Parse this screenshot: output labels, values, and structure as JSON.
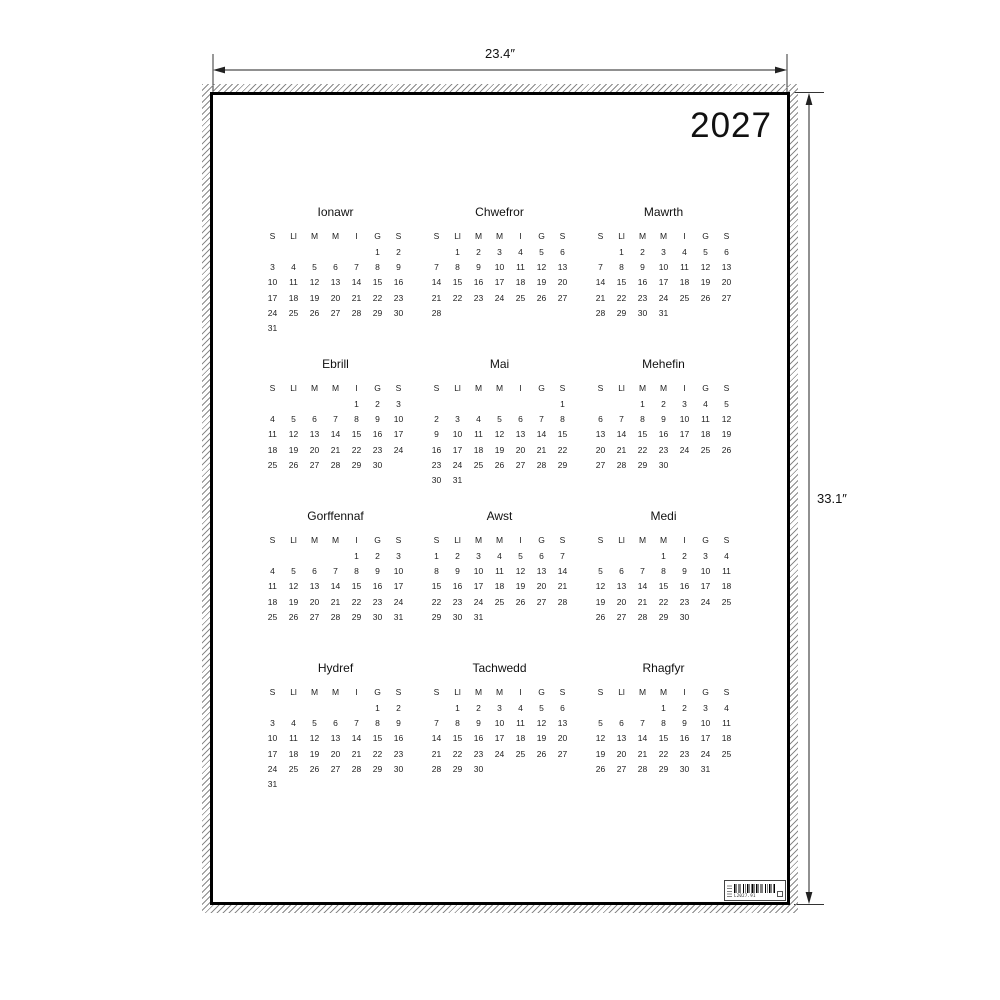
{
  "poster": {
    "year": "2027",
    "width_label": "23.4″",
    "height_label": "33.1″"
  },
  "colors": {
    "ink": "#1a1a1a",
    "poster_border": "#000000",
    "hatch": "#8a8a8a",
    "background": "#ffffff"
  },
  "barcode": {
    "code": "L2027.91"
  },
  "calendar": {
    "day_headers": [
      "S",
      "Ll",
      "M",
      "M",
      "I",
      "G",
      "S"
    ],
    "months": [
      {
        "name": "Ionawr",
        "weeks": [
          [
            "",
            "",
            "",
            "",
            "",
            "1",
            "2"
          ],
          [
            "3",
            "4",
            "5",
            "6",
            "7",
            "8",
            "9"
          ],
          [
            "10",
            "11",
            "12",
            "13",
            "14",
            "15",
            "16"
          ],
          [
            "17",
            "18",
            "19",
            "20",
            "21",
            "22",
            "23"
          ],
          [
            "24",
            "25",
            "26",
            "27",
            "28",
            "29",
            "30"
          ],
          [
            "31",
            "",
            "",
            "",
            "",
            "",
            ""
          ]
        ]
      },
      {
        "name": "Chwefror",
        "weeks": [
          [
            "",
            "1",
            "2",
            "3",
            "4",
            "5",
            "6"
          ],
          [
            "7",
            "8",
            "9",
            "10",
            "11",
            "12",
            "13"
          ],
          [
            "14",
            "15",
            "16",
            "17",
            "18",
            "19",
            "20"
          ],
          [
            "21",
            "22",
            "23",
            "24",
            "25",
            "26",
            "27"
          ],
          [
            "28",
            "",
            "",
            "",
            "",
            "",
            ""
          ],
          [
            "",
            "",
            "",
            "",
            "",
            "",
            ""
          ]
        ]
      },
      {
        "name": "Mawrth",
        "weeks": [
          [
            "",
            "1",
            "2",
            "3",
            "4",
            "5",
            "6"
          ],
          [
            "7",
            "8",
            "9",
            "10",
            "11",
            "12",
            "13"
          ],
          [
            "14",
            "15",
            "16",
            "17",
            "18",
            "19",
            "20"
          ],
          [
            "21",
            "22",
            "23",
            "24",
            "25",
            "26",
            "27"
          ],
          [
            "28",
            "29",
            "30",
            "31",
            "",
            "",
            ""
          ],
          [
            "",
            "",
            "",
            "",
            "",
            "",
            ""
          ]
        ]
      },
      {
        "name": "Ebrill",
        "weeks": [
          [
            "",
            "",
            "",
            "",
            "1",
            "2",
            "3"
          ],
          [
            "4",
            "5",
            "6",
            "7",
            "8",
            "9",
            "10"
          ],
          [
            "11",
            "12",
            "13",
            "14",
            "15",
            "16",
            "17"
          ],
          [
            "18",
            "19",
            "20",
            "21",
            "22",
            "23",
            "24"
          ],
          [
            "25",
            "26",
            "27",
            "28",
            "29",
            "30",
            ""
          ],
          [
            "",
            "",
            "",
            "",
            "",
            "",
            ""
          ]
        ]
      },
      {
        "name": "Mai",
        "weeks": [
          [
            "",
            "",
            "",
            "",
            "",
            "",
            "1"
          ],
          [
            "2",
            "3",
            "4",
            "5",
            "6",
            "7",
            "8"
          ],
          [
            "9",
            "10",
            "11",
            "12",
            "13",
            "14",
            "15"
          ],
          [
            "16",
            "17",
            "18",
            "19",
            "20",
            "21",
            "22"
          ],
          [
            "23",
            "24",
            "25",
            "26",
            "27",
            "28",
            "29"
          ],
          [
            "30",
            "31",
            "",
            "",
            "",
            "",
            ""
          ]
        ]
      },
      {
        "name": "Mehefin",
        "weeks": [
          [
            "",
            "",
            "1",
            "2",
            "3",
            "4",
            "5"
          ],
          [
            "6",
            "7",
            "8",
            "9",
            "10",
            "11",
            "12"
          ],
          [
            "13",
            "14",
            "15",
            "16",
            "17",
            "18",
            "19"
          ],
          [
            "20",
            "21",
            "22",
            "23",
            "24",
            "25",
            "26"
          ],
          [
            "27",
            "28",
            "29",
            "30",
            "",
            "",
            ""
          ],
          [
            "",
            "",
            "",
            "",
            "",
            "",
            ""
          ]
        ]
      },
      {
        "name": "Gorffennaf",
        "weeks": [
          [
            "",
            "",
            "",
            "",
            "1",
            "2",
            "3"
          ],
          [
            "4",
            "5",
            "6",
            "7",
            "8",
            "9",
            "10"
          ],
          [
            "11",
            "12",
            "13",
            "14",
            "15",
            "16",
            "17"
          ],
          [
            "18",
            "19",
            "20",
            "21",
            "22",
            "23",
            "24"
          ],
          [
            "25",
            "26",
            "27",
            "28",
            "29",
            "30",
            "31"
          ],
          [
            "",
            "",
            "",
            "",
            "",
            "",
            ""
          ]
        ]
      },
      {
        "name": "Awst",
        "weeks": [
          [
            "1",
            "2",
            "3",
            "4",
            "5",
            "6",
            "7"
          ],
          [
            "8",
            "9",
            "10",
            "11",
            "12",
            "13",
            "14"
          ],
          [
            "15",
            "16",
            "17",
            "18",
            "19",
            "20",
            "21"
          ],
          [
            "22",
            "23",
            "24",
            "25",
            "26",
            "27",
            "28"
          ],
          [
            "29",
            "30",
            "31",
            "",
            "",
            "",
            ""
          ],
          [
            "",
            "",
            "",
            "",
            "",
            "",
            ""
          ]
        ]
      },
      {
        "name": "Medi",
        "weeks": [
          [
            "",
            "",
            "",
            "1",
            "2",
            "3",
            "4"
          ],
          [
            "5",
            "6",
            "7",
            "8",
            "9",
            "10",
            "11"
          ],
          [
            "12",
            "13",
            "14",
            "15",
            "16",
            "17",
            "18"
          ],
          [
            "19",
            "20",
            "21",
            "22",
            "23",
            "24",
            "25"
          ],
          [
            "26",
            "27",
            "28",
            "29",
            "30",
            "",
            ""
          ],
          [
            "",
            "",
            "",
            "",
            "",
            "",
            ""
          ]
        ]
      },
      {
        "name": "Hydref",
        "weeks": [
          [
            "",
            "",
            "",
            "",
            "",
            "1",
            "2"
          ],
          [
            "3",
            "4",
            "5",
            "6",
            "7",
            "8",
            "9"
          ],
          [
            "10",
            "11",
            "12",
            "13",
            "14",
            "15",
            "16"
          ],
          [
            "17",
            "18",
            "19",
            "20",
            "21",
            "22",
            "23"
          ],
          [
            "24",
            "25",
            "26",
            "27",
            "28",
            "29",
            "30"
          ],
          [
            "31",
            "",
            "",
            "",
            "",
            "",
            ""
          ]
        ]
      },
      {
        "name": "Tachwedd",
        "weeks": [
          [
            "",
            "1",
            "2",
            "3",
            "4",
            "5",
            "6"
          ],
          [
            "7",
            "8",
            "9",
            "10",
            "11",
            "12",
            "13"
          ],
          [
            "14",
            "15",
            "16",
            "17",
            "18",
            "19",
            "20"
          ],
          [
            "21",
            "22",
            "23",
            "24",
            "25",
            "26",
            "27"
          ],
          [
            "28",
            "29",
            "30",
            "",
            "",
            "",
            ""
          ],
          [
            "",
            "",
            "",
            "",
            "",
            "",
            ""
          ]
        ]
      },
      {
        "name": "Rhagfyr",
        "weeks": [
          [
            "",
            "",
            "",
            "1",
            "2",
            "3",
            "4"
          ],
          [
            "5",
            "6",
            "7",
            "8",
            "9",
            "10",
            "11"
          ],
          [
            "12",
            "13",
            "14",
            "15",
            "16",
            "17",
            "18"
          ],
          [
            "19",
            "20",
            "21",
            "22",
            "23",
            "24",
            "25"
          ],
          [
            "26",
            "27",
            "28",
            "29",
            "30",
            "31",
            ""
          ],
          [
            "",
            "",
            "",
            "",
            "",
            "",
            ""
          ]
        ]
      }
    ]
  }
}
